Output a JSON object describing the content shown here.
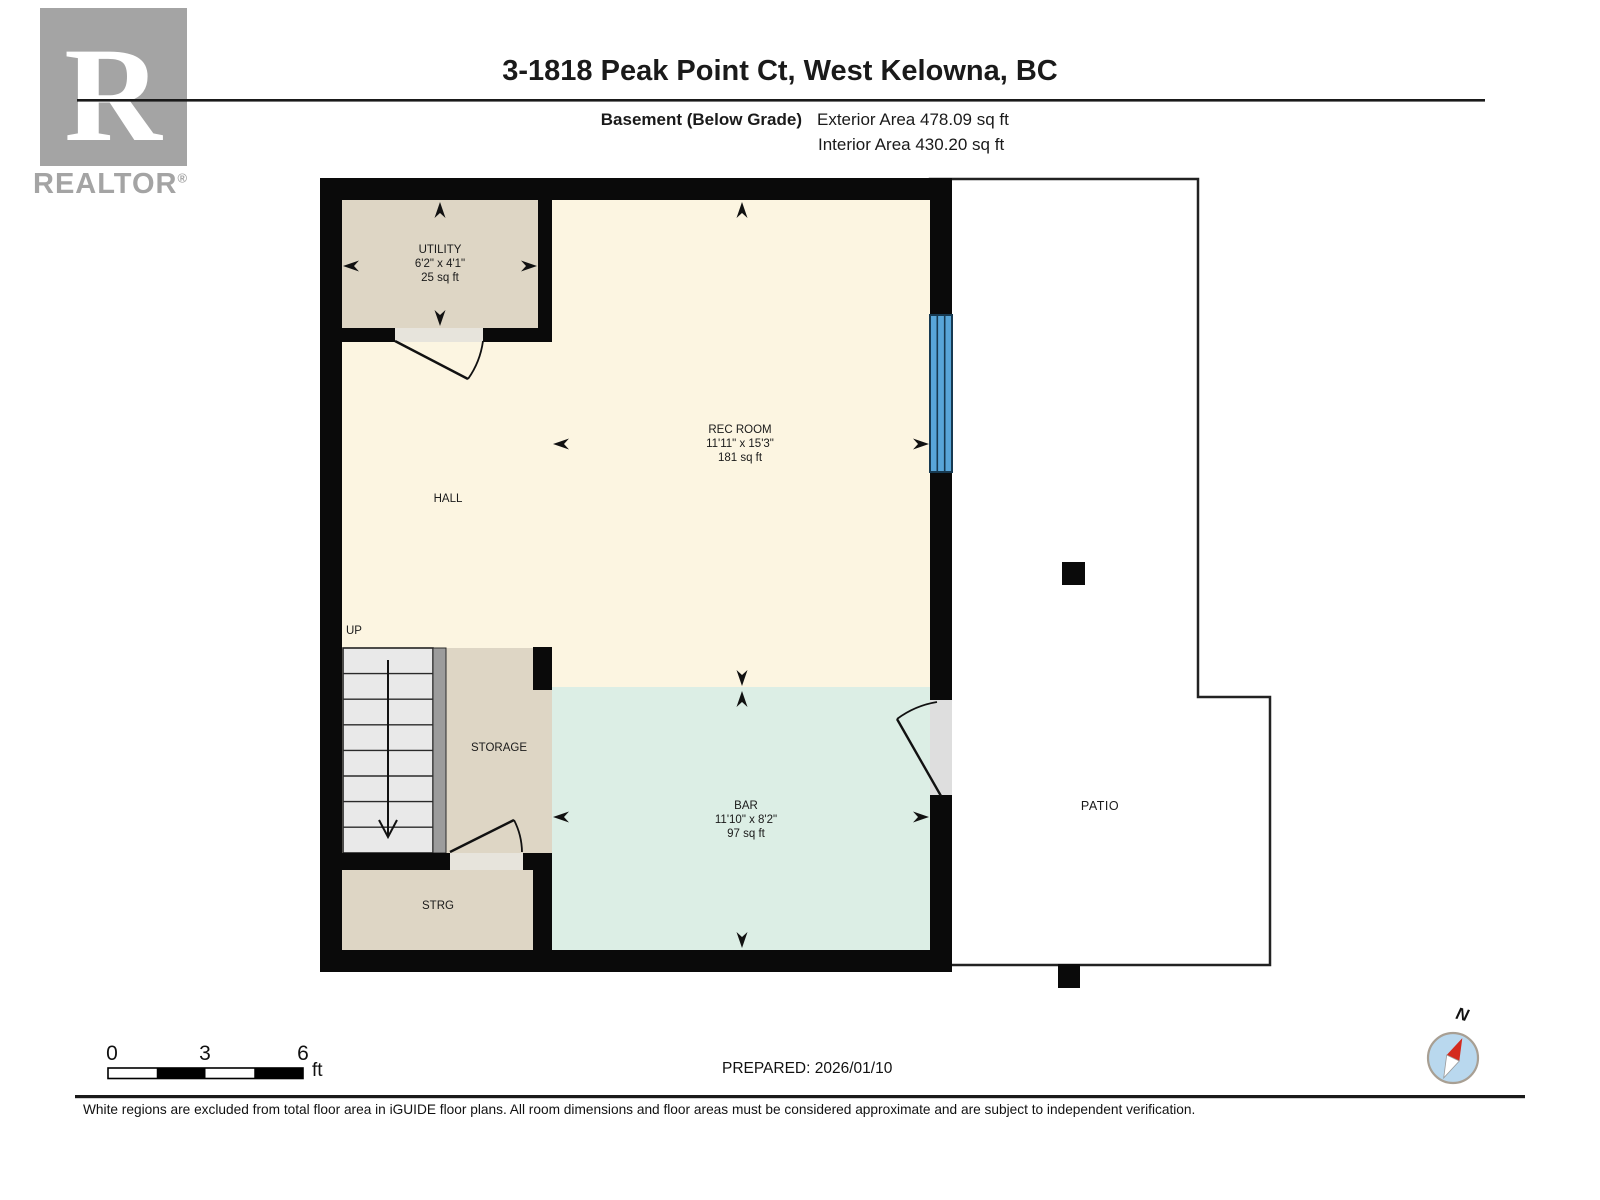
{
  "logo": {
    "brand": "REALTOR",
    "reg": "®",
    "letter": "R"
  },
  "header": {
    "title": "3-1818 Peak Point Ct, West Kelowna, BC",
    "floor_label": "Basement (Below Grade)",
    "exterior_area": "Exterior Area 478.09 sq ft",
    "interior_area": "Interior Area 430.20 sq ft"
  },
  "rooms": {
    "utility": {
      "name": "UTILITY",
      "dims": "6'2\" x 4'1\"",
      "area": "25 sq ft"
    },
    "rec_room": {
      "name": "REC ROOM",
      "dims": "11'11\" x 15'3\"",
      "area": "181 sq ft"
    },
    "hall": {
      "name": "HALL"
    },
    "storage": {
      "name": "STORAGE"
    },
    "strg": {
      "name": "STRG"
    },
    "bar": {
      "name": "BAR",
      "dims": "11'10\" x 8'2\"",
      "area": "97 sq ft"
    },
    "patio": {
      "name": "PATIO"
    }
  },
  "stairs": {
    "direction_label": "UP"
  },
  "scale_bar": {
    "tick_0": "0",
    "tick_3": "3",
    "tick_6": "6",
    "unit": "ft"
  },
  "prepared_label": "PREPARED: 2026/01/10",
  "compass": {
    "north_label": "N"
  },
  "footer": {
    "disclaimer": "White regions are excluded from total floor area in iGUIDE floor plans. All room dimensions and floor areas must be considered approximate and are subject to independent verification."
  },
  "colors": {
    "wall": "#0a0a0a",
    "interior_cream": "#fcf5e1",
    "secondary_beige": "#ded6c5",
    "bar_teal": "#dceee5",
    "window_blue": "#58a5d8",
    "stairs_gray": "#e9e9e9",
    "railing_gray": "#9c9c9c",
    "compass_face": "#b9d8ee",
    "needle_red": "#d42a1e",
    "logo_gray": "#a4a4a4"
  }
}
